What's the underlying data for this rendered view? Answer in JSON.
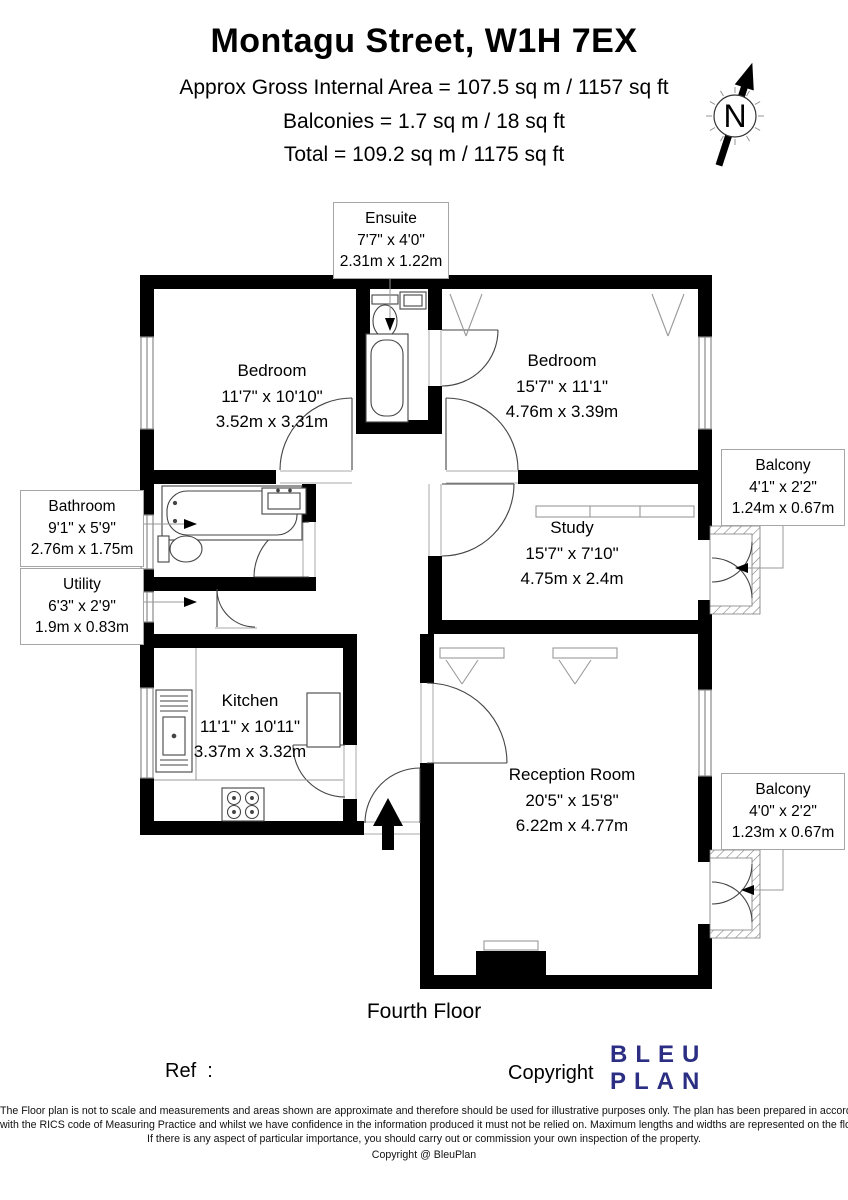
{
  "header": {
    "title": "Montagu Street, W1H 7EX",
    "area_line": "Approx Gross Internal Area = 107.5 sq m / 1157 sq ft",
    "balconies_line": "Balconies = 1.7 sq m / 18 sq ft",
    "total_line": "Total = 109.2 sq m / 1175 sq ft"
  },
  "compass": {
    "label": "N"
  },
  "rooms": {
    "bedroom_left": {
      "name": "Bedroom",
      "imperial": "11'7\" x 10'10\"",
      "metric": "3.52m x 3.31m"
    },
    "bedroom_right": {
      "name": "Bedroom",
      "imperial": "15'7\" x 11'1\"",
      "metric": "4.76m x 3.39m"
    },
    "study": {
      "name": "Study",
      "imperial": "15'7\" x 7'10\"",
      "metric": "4.75m x 2.4m"
    },
    "kitchen": {
      "name": "Kitchen",
      "imperial": "11'1\" x 10'11\"",
      "metric": "3.37m x 3.32m"
    },
    "reception": {
      "name": "Reception Room",
      "imperial": "20'5\" x 15'8\"",
      "metric": "6.22m x 4.77m"
    }
  },
  "callouts": {
    "ensuite": {
      "name": "Ensuite",
      "imperial": "7'7\" x 4'0\"",
      "metric": "2.31m x 1.22m"
    },
    "bathroom": {
      "name": "Bathroom",
      "imperial": "9'1\" x 5'9\"",
      "metric": "2.76m x 1.75m"
    },
    "utility": {
      "name": "Utility",
      "imperial": "6'3\" x 2'9\"",
      "metric": "1.9m x 0.83m"
    },
    "balcony_upper": {
      "name": "Balcony",
      "imperial": "4'1\" x 2'2\"",
      "metric": "1.24m x 0.67m"
    },
    "balcony_lower": {
      "name": "Balcony",
      "imperial": "4'0\" x 2'2\"",
      "metric": "1.23m x 0.67m"
    }
  },
  "floor_label": "Fourth Floor",
  "footer": {
    "ref_label": "Ref  :",
    "copyright_label": "Copyright",
    "logo_line1": "BLEU",
    "logo_line2": "PLAN",
    "disclaimer": {
      "l1": "The Floor plan is not to scale and measurements and areas shown are approximate and therefore should be used for illustrative purposes only. The plan has been prepared in accordance",
      "l2": "with the RICS code of Measuring Practice and whilst we have confidence in the information produced it must not be relied on. Maximum lengths and widths are represented on the floor plan.",
      "l3": "If there is any aspect of particular importance, you should carry out or commission your own inspection of the property."
    },
    "copyright_note": "Copyright @ BleuPlan"
  },
  "colors": {
    "wall": "#000000",
    "logo_navy": "#2b2e83",
    "window_gray": "#8a8a8a",
    "callout_border": "#a6a6a6"
  }
}
